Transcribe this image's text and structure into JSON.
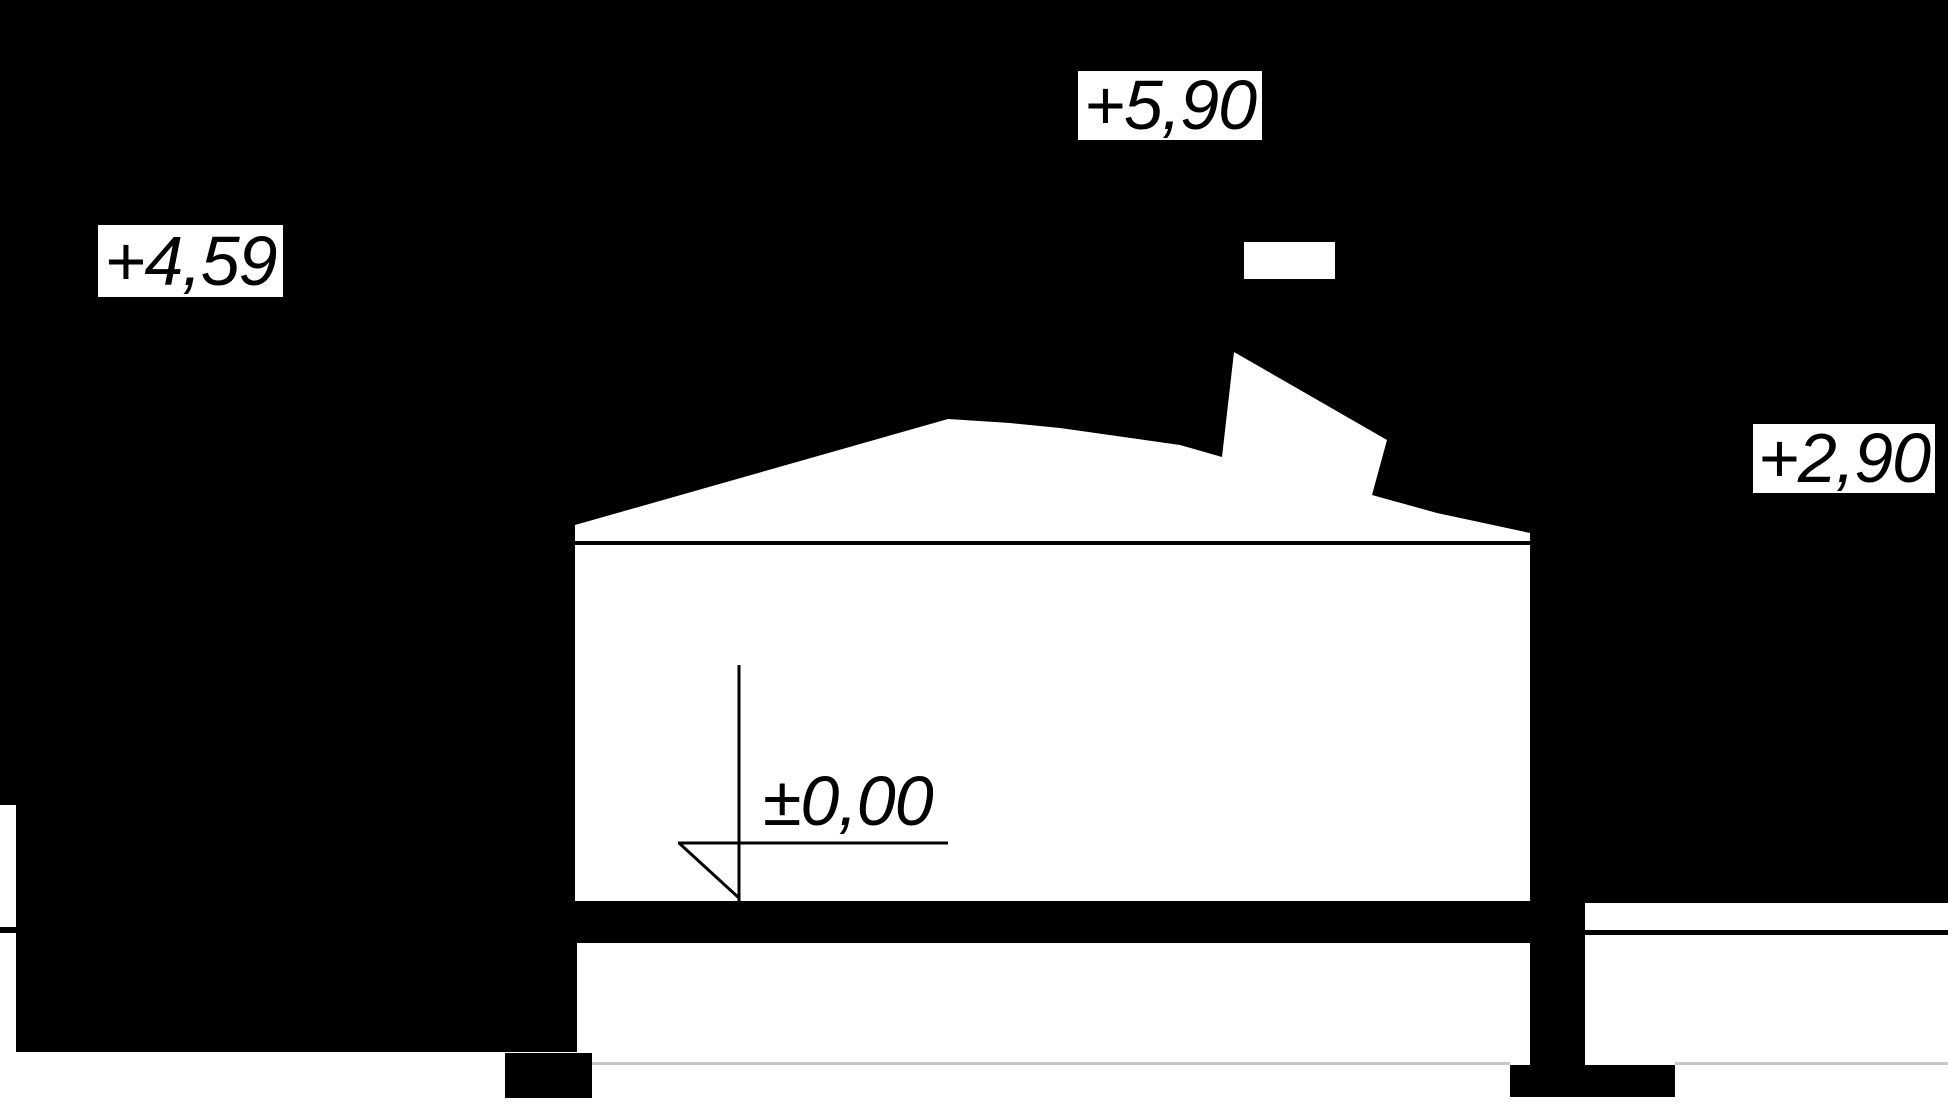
{
  "drawing": {
    "kind": "building-section-elevation",
    "level_labels": {
      "top": "+5,90",
      "left": "+4,59",
      "right": "+2,90",
      "ground": "±0,00"
    }
  },
  "colors": {
    "background": "#000000",
    "surface": "#ffffff",
    "ink": "#000000",
    "faint_line": "#c9c9c9"
  }
}
